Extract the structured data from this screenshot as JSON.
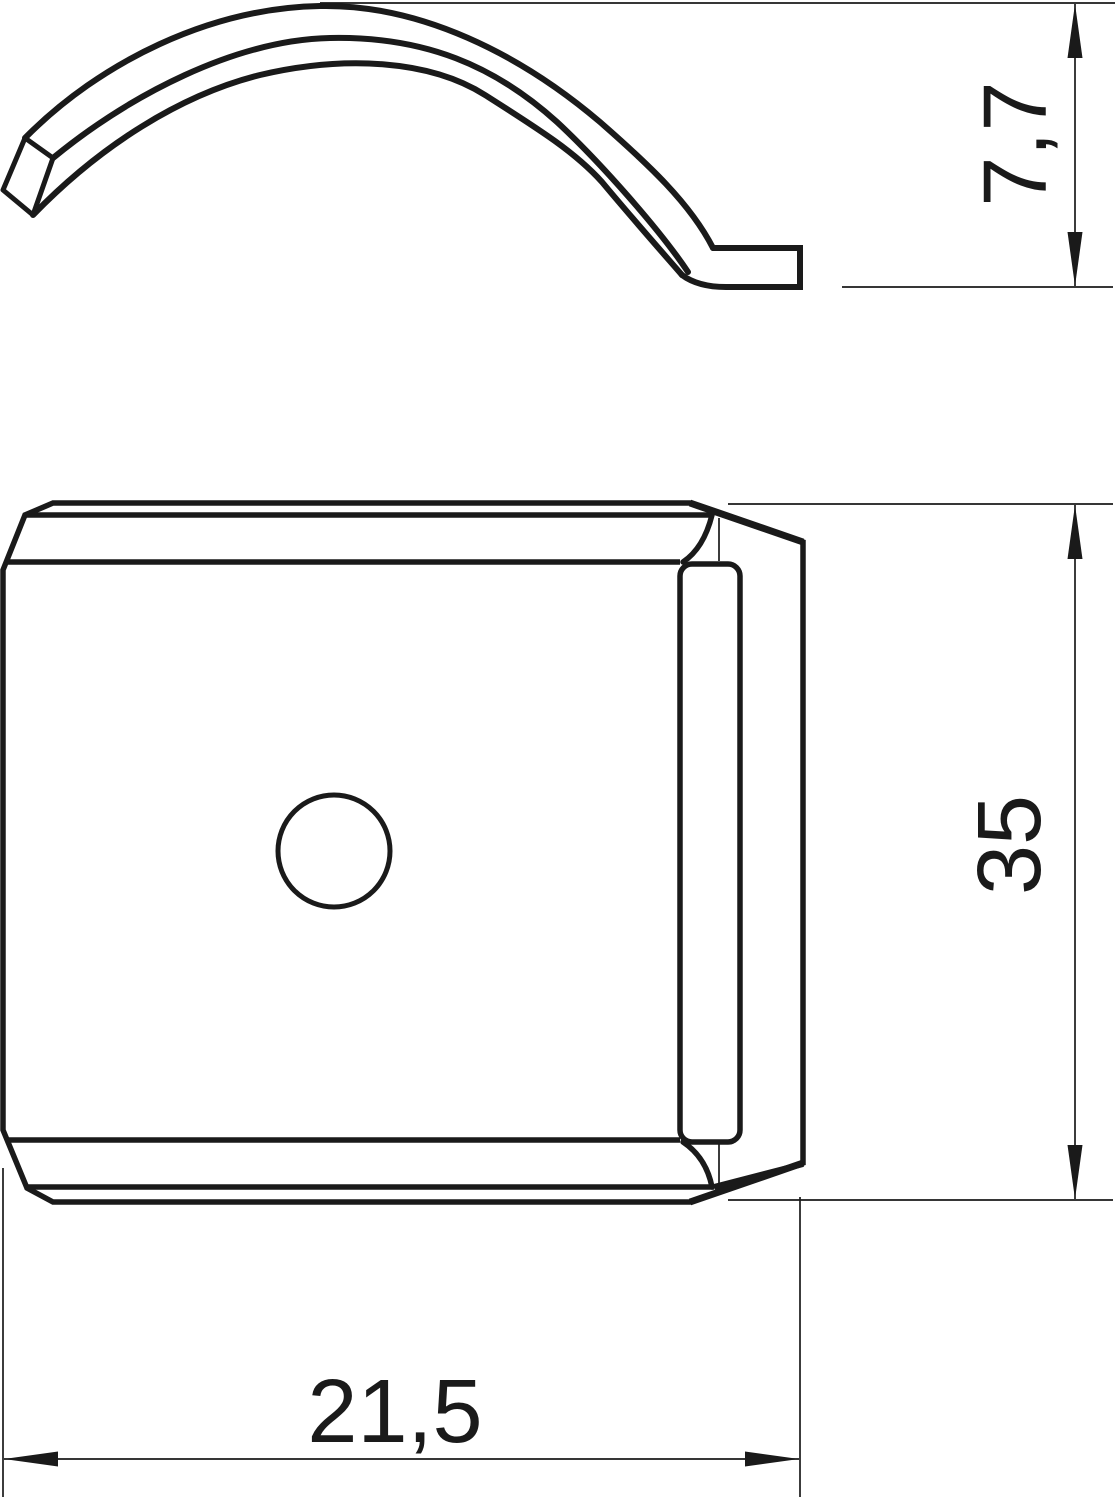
{
  "drawing": {
    "background": "#ffffff",
    "line_color": "#1a1a1a",
    "views": {
      "side_profile": "curved-clamp-strip-with-foot",
      "front": "square-plate-with-center-hole"
    },
    "dims": {
      "clip_height": {
        "value": "7,7",
        "orientation": "vertical"
      },
      "plate_height": {
        "value": "35",
        "orientation": "vertical"
      },
      "plate_width": {
        "value": "21,5",
        "orientation": "horizontal"
      }
    }
  }
}
